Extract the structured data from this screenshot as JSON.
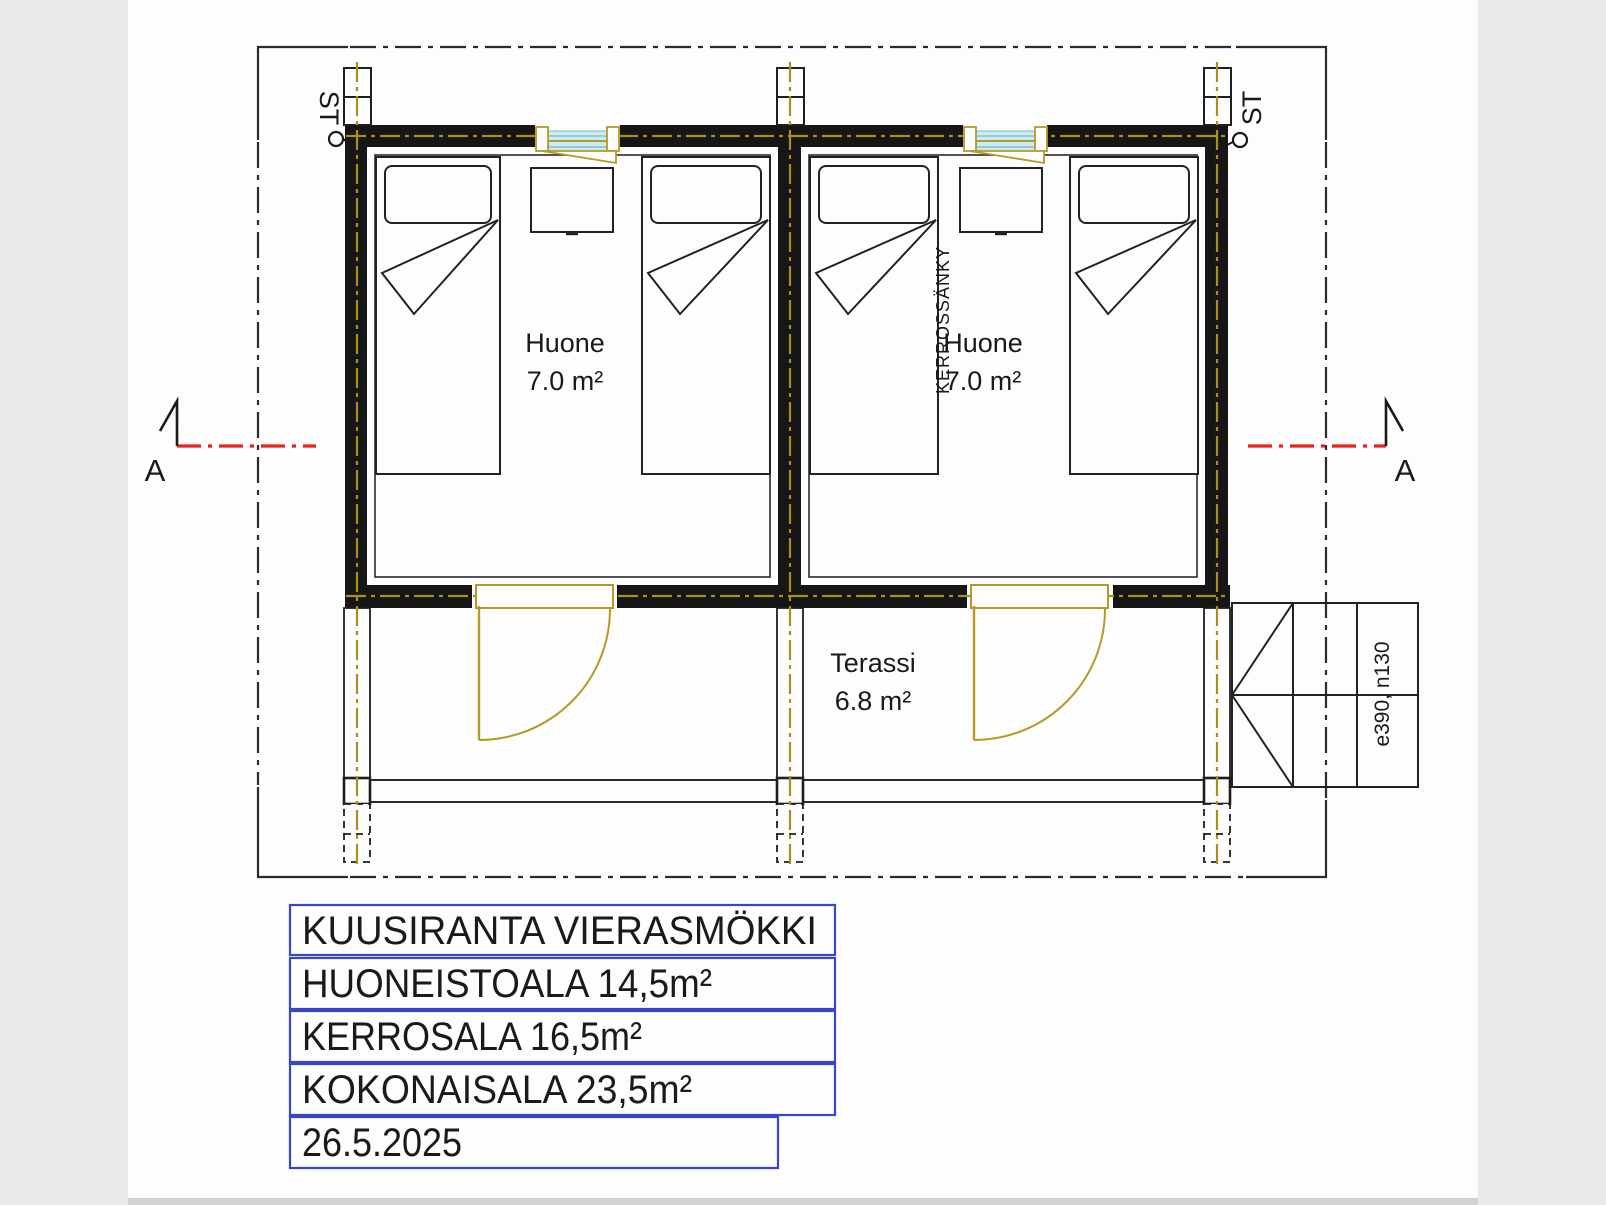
{
  "plan": {
    "site_label_left": "ST",
    "site_label_right": "ST",
    "section_marker_left": "A",
    "section_marker_right": "A",
    "rooms": [
      {
        "name": "Huone",
        "area": "7.0 m²"
      },
      {
        "name": "Huone",
        "area": "7.0 m²"
      }
    ],
    "terrace": {
      "name": "Terassi",
      "area": "6.8 m²"
    },
    "bunk_bed_label": "KERROSSÄNKY",
    "steps_label": "e390, n130"
  },
  "title_block": {
    "rows": [
      {
        "label": "KUUSIRANTA VIERASMÖKKI"
      },
      {
        "label": "HUONEISTOALA 14,5m²"
      },
      {
        "label": "KERROSALA 16,5m²"
      },
      {
        "label": "KOKONAISALA 23,5m²"
      },
      {
        "label": "26.5.2025"
      }
    ]
  },
  "colors": {
    "paper": "#fdfdfd",
    "margin": "#e9e9e9",
    "wall": "#161616",
    "centerline_olive": "#a98f1c",
    "frame_yellow": "#b59a25",
    "glazing_blue": "#cdebf2",
    "section_red": "#e8221c",
    "title_border": "#3a46c8",
    "thin_line": "#2b2b2b"
  }
}
